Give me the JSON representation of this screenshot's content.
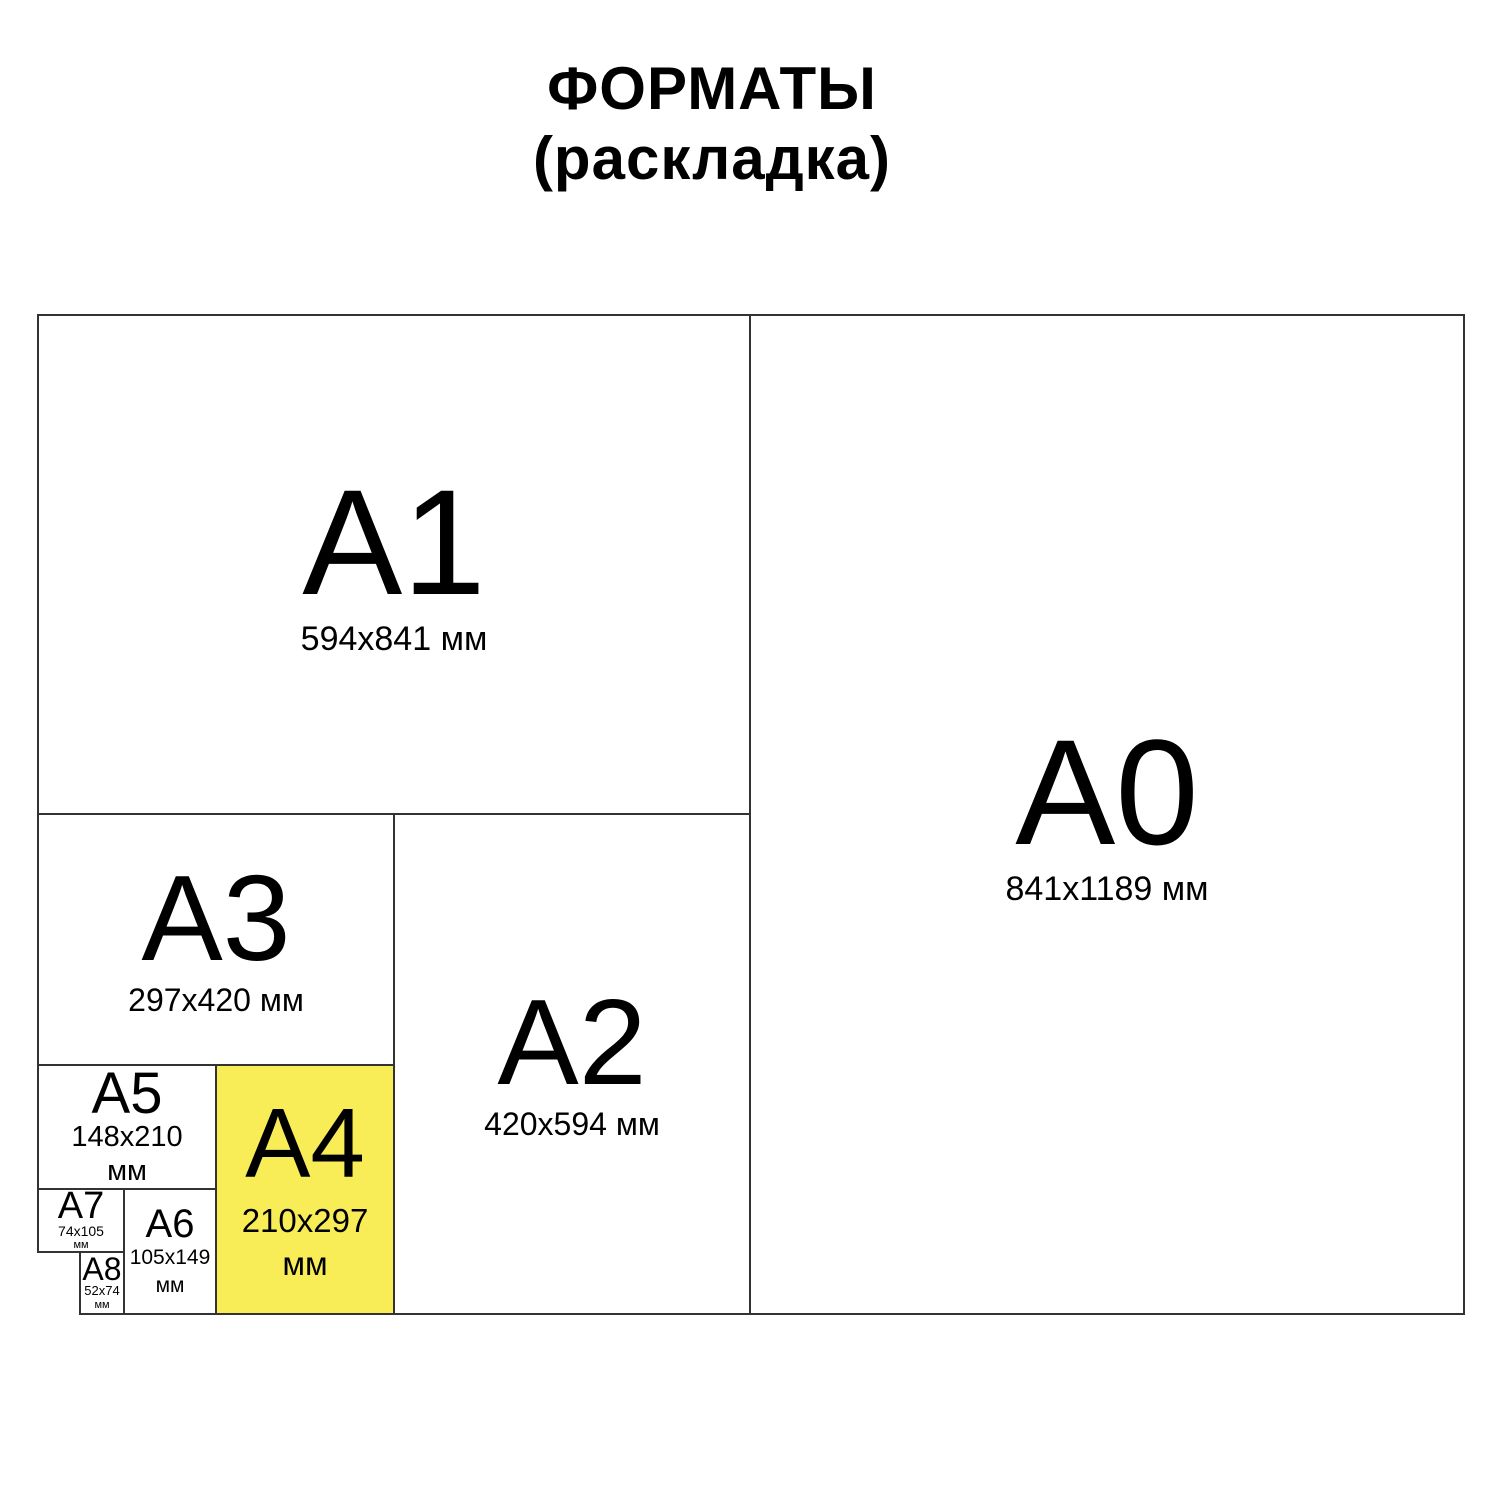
{
  "title": {
    "line1": "ФОРМАТЫ",
    "line2": "(раскладка)"
  },
  "colors": {
    "highlight_yellow": "#F8ED57",
    "border": "#333333",
    "text": "#000000",
    "background": "#ffffff"
  },
  "formats": {
    "a0": {
      "label": "A0",
      "dims": "841x1189 мм"
    },
    "a1": {
      "label": "A1",
      "dims": "594x841 мм"
    },
    "a2": {
      "label": "A2",
      "dims": "420x594 мм"
    },
    "a3": {
      "label": "A3",
      "dims": "297x420 мм"
    },
    "a4": {
      "label": "A4",
      "dims_line1": "210x297",
      "dims_line2": "мм",
      "highlighted": "true"
    },
    "a5": {
      "label": "A5",
      "dims_line1": "148x210",
      "dims_line2": "мм"
    },
    "a6": {
      "label": "A6",
      "dims_line1": "105x149",
      "dims_line2": "мм"
    },
    "a7": {
      "label": "A7",
      "dims_line1": "74x105",
      "dims_line2": "мм"
    },
    "a8": {
      "label": "A8",
      "dims_line1": "52x74",
      "dims_line2": "мм"
    }
  }
}
